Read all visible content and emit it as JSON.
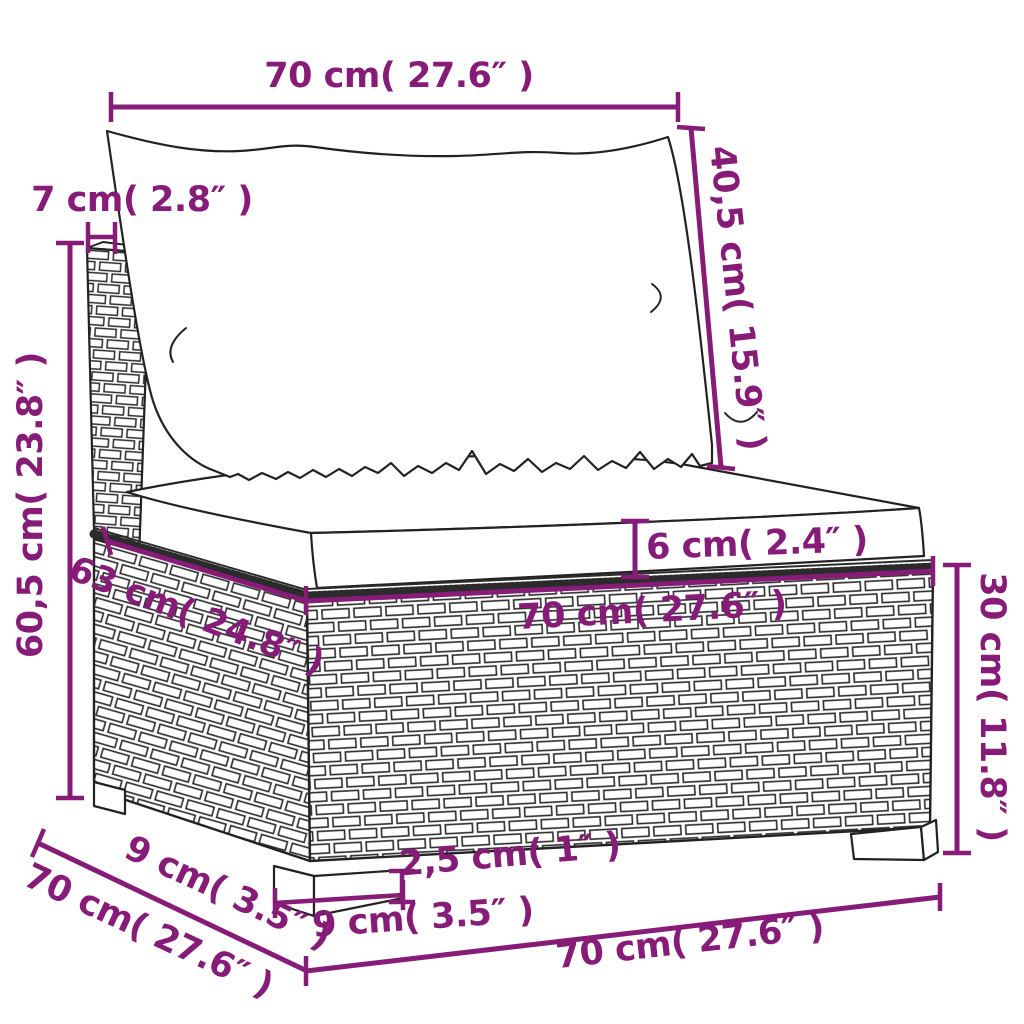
{
  "diagram": {
    "subject": "poly rattan garden sofa middle section with back cushion and seat cushion",
    "colors": {
      "dimension_annotation": "#871B78",
      "line_art": "#222222",
      "background": "#FFFFFF"
    },
    "units": [
      "cm",
      "inches"
    ],
    "dimensions": {
      "back_cushion_width": {
        "label": "70 cm( 27.6″ )",
        "cm": 70,
        "inches": 27.6
      },
      "back_post_thickness": {
        "label": "7 cm( 2.8″ )",
        "cm": 7,
        "inches": 2.8
      },
      "back_cushion_height": {
        "label": "40,5 cm( 15.9″ )",
        "cm": 40.5,
        "inches": 15.9
      },
      "overall_height": {
        "label": "60,5 cm( 23.8″ )",
        "cm": 60.5,
        "inches": 23.8
      },
      "seat_cushion_thickness": {
        "label": "6 cm( 2.4″ )",
        "cm": 6,
        "inches": 2.4
      },
      "seat_depth": {
        "label": "63 cm( 24.8″ )",
        "cm": 63,
        "inches": 24.8
      },
      "seat_width": {
        "label": "70 cm( 27.6″ )",
        "cm": 70,
        "inches": 27.6
      },
      "base_height": {
        "label": "30 cm( 11.8″ )",
        "cm": 30,
        "inches": 11.8
      },
      "foot_depth": {
        "label": "9 cm( 3.5″ )",
        "cm": 9,
        "inches": 3.5
      },
      "side_depth": {
        "label": "70 cm( 27.6″ )",
        "cm": 70,
        "inches": 27.6
      },
      "foot_height": {
        "label": "2,5 cm( 1″ )",
        "cm": 2.5,
        "inches": 1
      },
      "foot_width": {
        "label": "9 cm( 3.5″ )",
        "cm": 9,
        "inches": 3.5
      },
      "overall_width": {
        "label": "70 cm( 27.6″ )",
        "cm": 70,
        "inches": 27.6
      }
    }
  }
}
